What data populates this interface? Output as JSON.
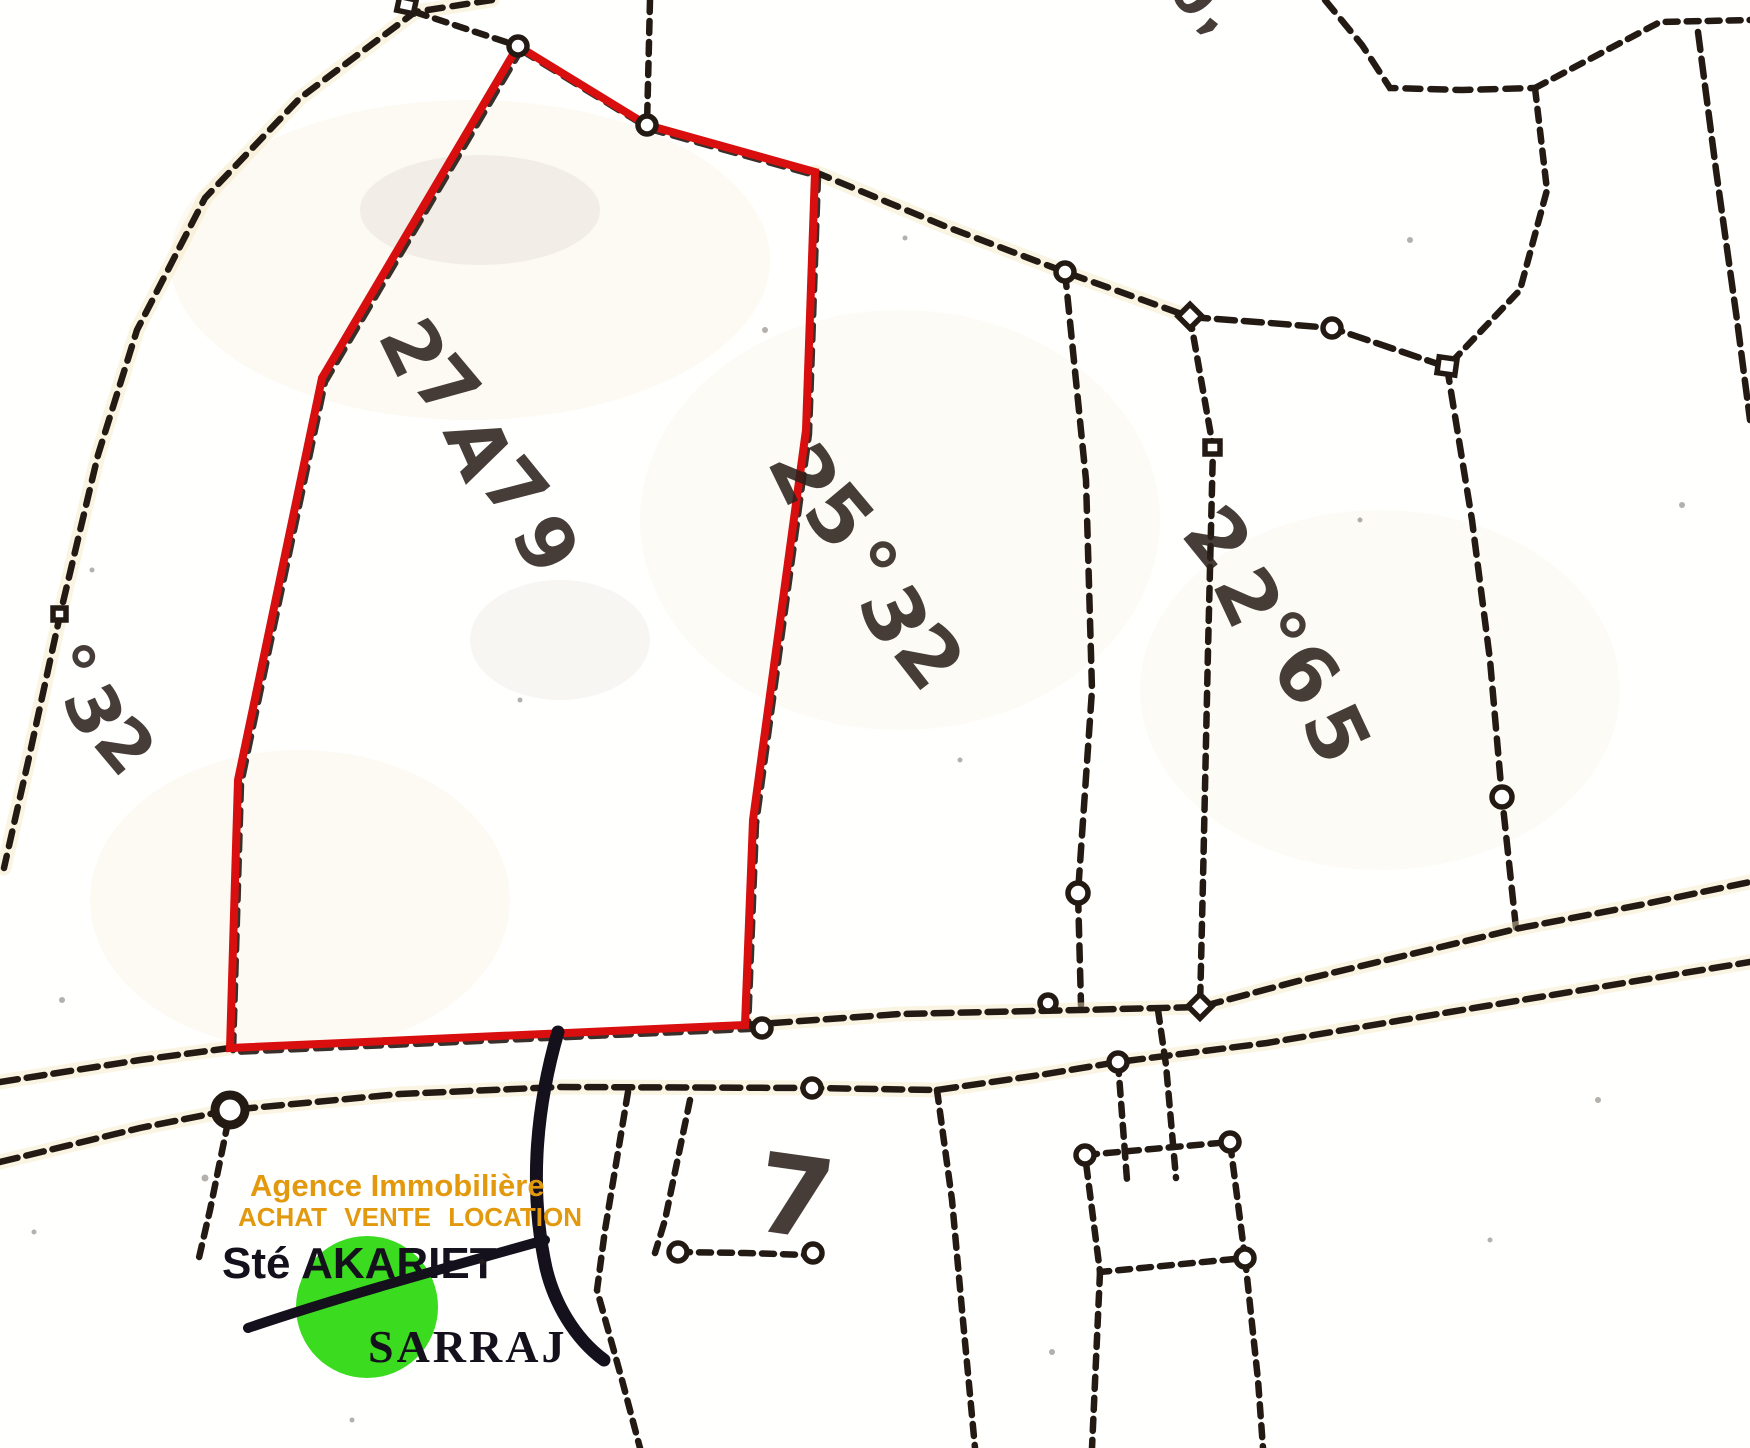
{
  "map": {
    "background_color": "#fffffe",
    "line_color": "#241a14",
    "highlight_color": "#d90e0e",
    "parcel_labels": {
      "highlighted": "27A79",
      "middle": "25°32",
      "right": "22°65",
      "far_left_partial": "°32",
      "top_edge_partial": "0,",
      "road_mark": "7"
    }
  },
  "logo": {
    "tagline1": "Agence Immobilière",
    "tagline2": "ACHAT VENTE LOCATION",
    "company": "Sté AKARIET",
    "name": "SARRAJ",
    "orange": "#e2990e",
    "green": "#3bdb20",
    "dark": "#14101c"
  }
}
